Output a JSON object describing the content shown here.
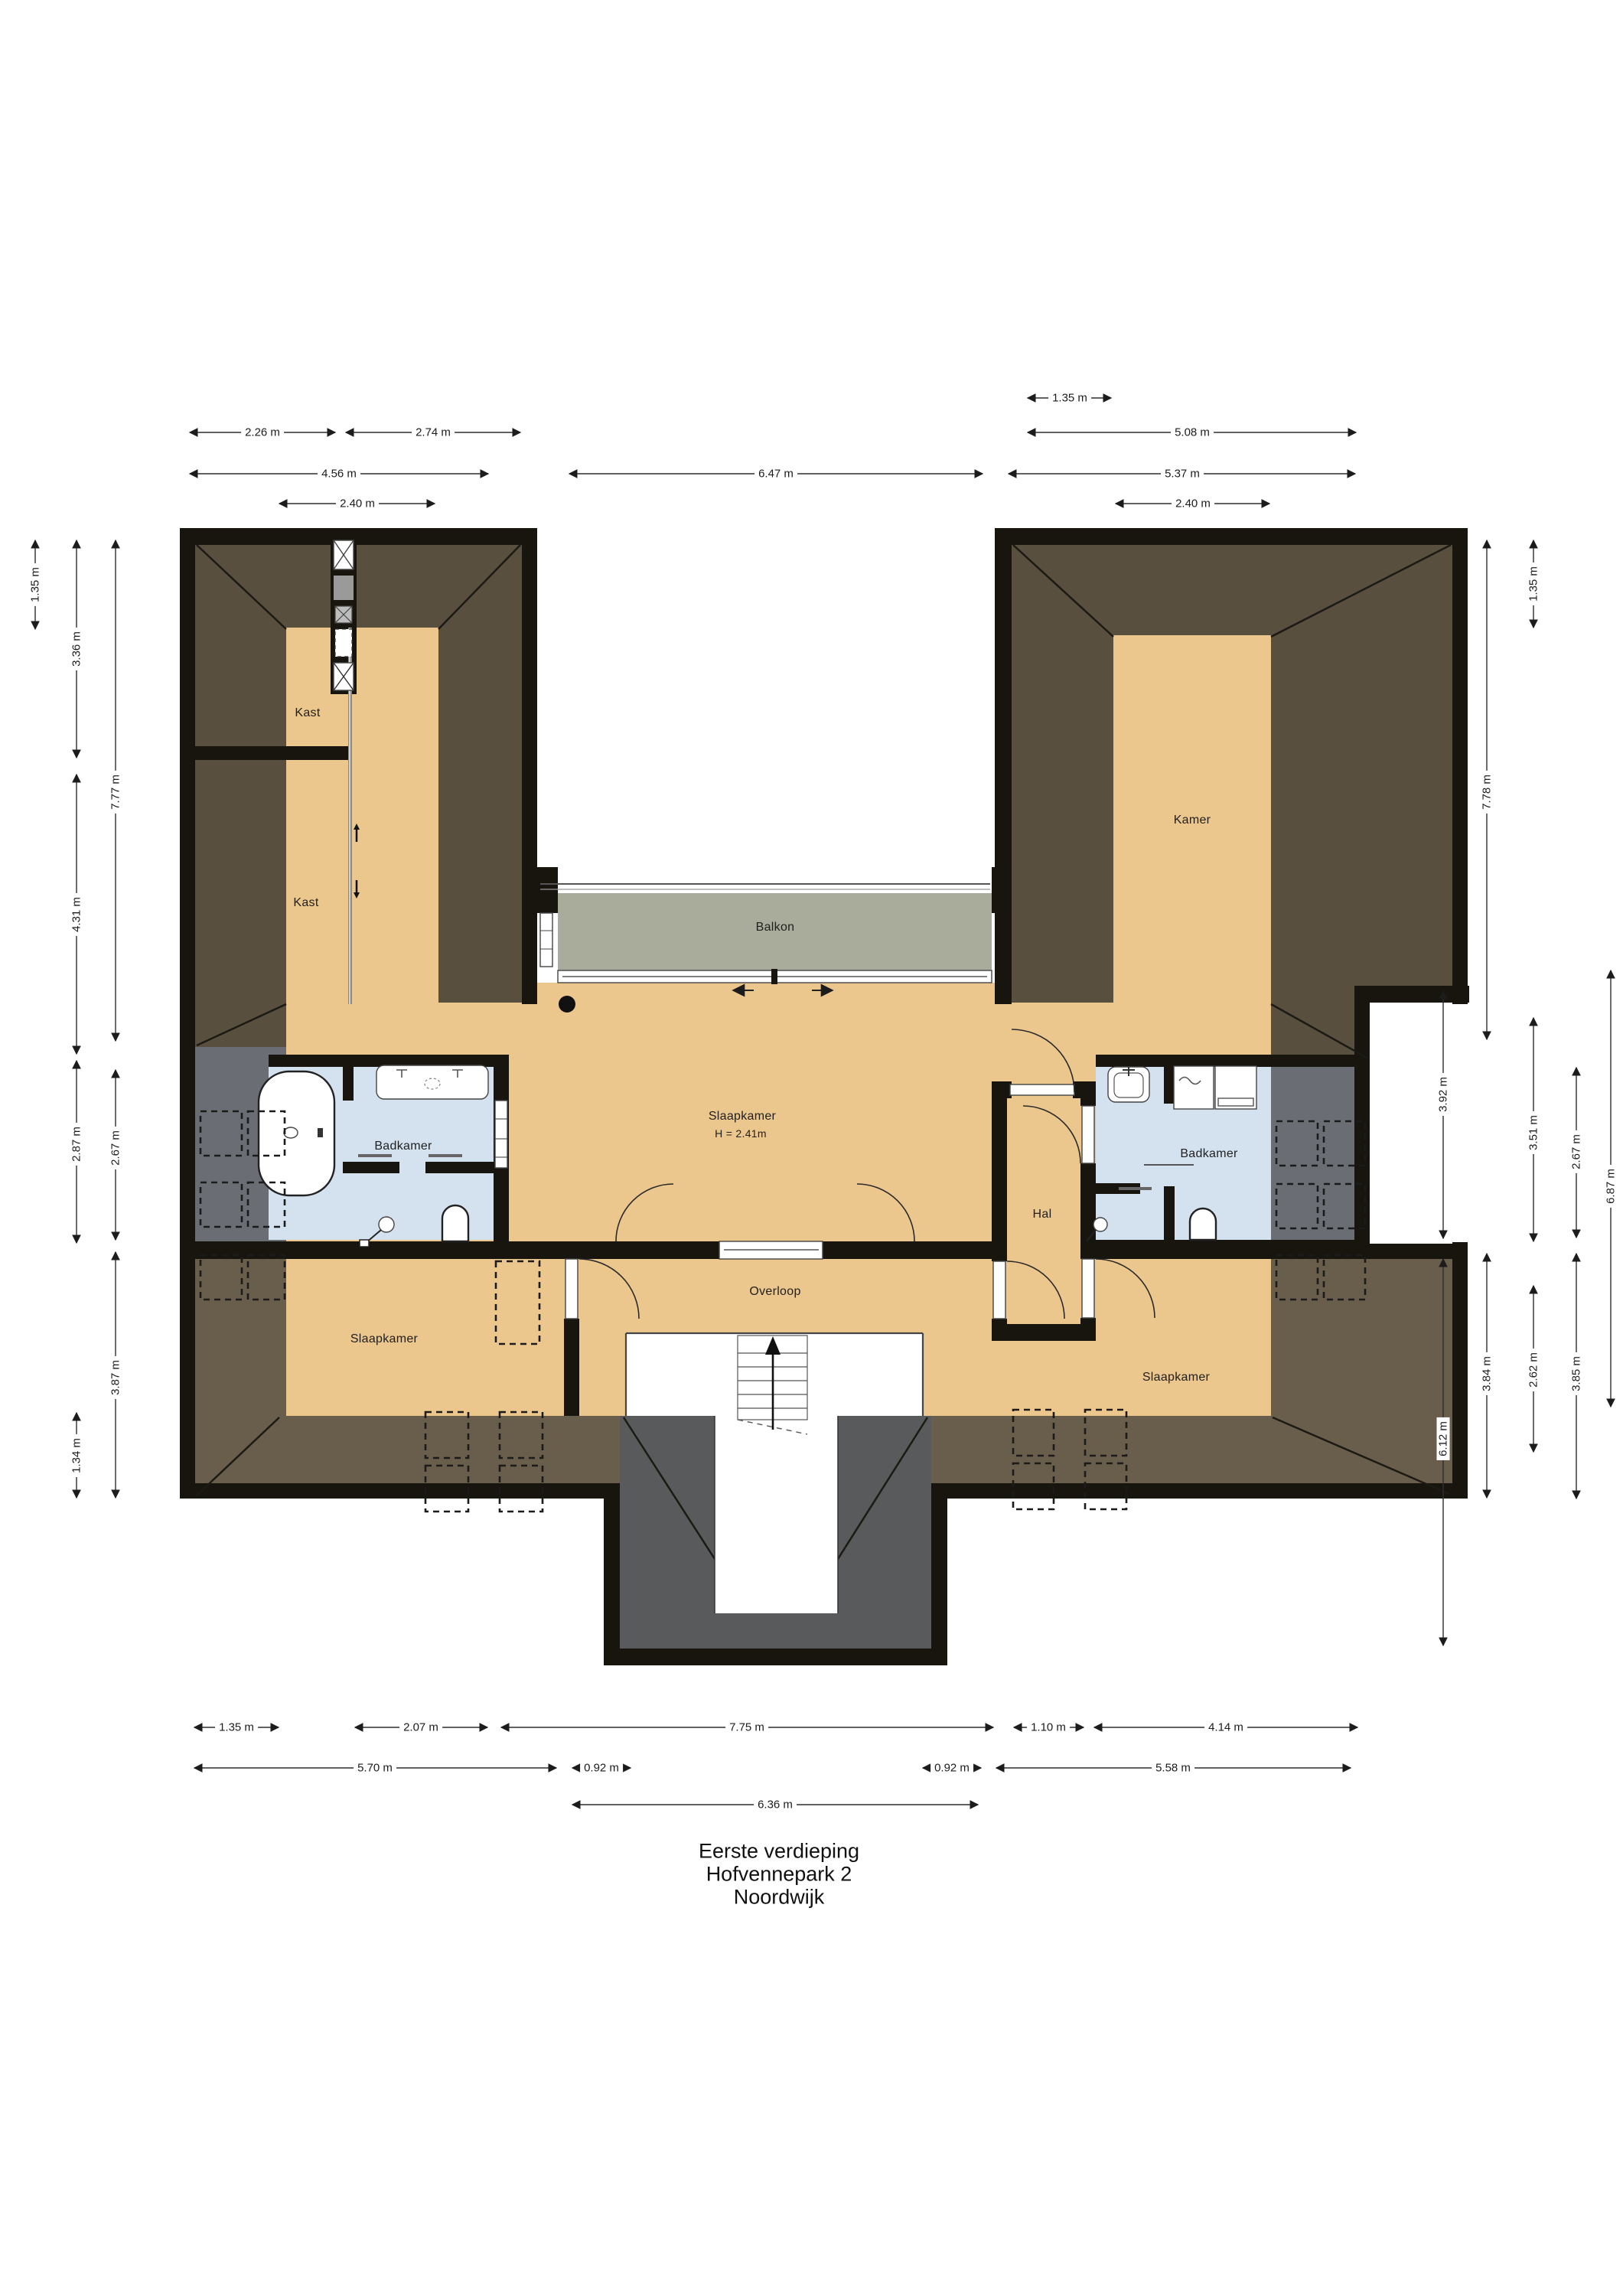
{
  "title": {
    "line1": "Eerste verdieping",
    "line2": "Hofvennepark 2",
    "line3": "Noordwijk"
  },
  "rooms": {
    "kast_top": "Kast",
    "kast_mid": "Kast",
    "kamer": "Kamer",
    "balkon": "Balkon",
    "slaapkamer_center": "Slaapkamer",
    "slaapkamer_center_height": "H = 2.41m",
    "badkamer_left": "Badkamer",
    "badkamer_right": "Badkamer",
    "hal": "Hal",
    "overloop": "Overloop",
    "slaapkamer_left": "Slaapkamer",
    "slaapkamer_right": "Slaapkamer"
  },
  "dimensions": {
    "top": [
      {
        "text": "2.26 m"
      },
      {
        "text": "2.74 m"
      },
      {
        "text": "1.35 m"
      },
      {
        "text": "4.56 m"
      },
      {
        "text": "6.47 m"
      },
      {
        "text": "5.08 m"
      },
      {
        "text": "5.37 m"
      },
      {
        "text": "2.40 m"
      },
      {
        "text": "2.40 m"
      }
    ],
    "left": [
      {
        "text": "1.35 m"
      },
      {
        "text": "3.36 m"
      },
      {
        "text": "4.31 m"
      },
      {
        "text": "7.77 m"
      },
      {
        "text": "2.87 m"
      },
      {
        "text": "2.67 m"
      },
      {
        "text": "3.87 m"
      },
      {
        "text": "1.34 m"
      }
    ],
    "right": [
      {
        "text": "7.78 m"
      },
      {
        "text": "1.35 m"
      },
      {
        "text": "3.92 m"
      },
      {
        "text": "6.12 m"
      },
      {
        "text": "3.84 m"
      },
      {
        "text": "3.51 m"
      },
      {
        "text": "2.62 m"
      },
      {
        "text": "2.67 m"
      },
      {
        "text": "3.85 m"
      },
      {
        "text": "6.87 m"
      }
    ],
    "bottom": [
      {
        "text": "1.35 m"
      },
      {
        "text": "2.07 m"
      },
      {
        "text": "7.75 m"
      },
      {
        "text": "1.10 m"
      },
      {
        "text": "4.14 m"
      },
      {
        "text": "5.70 m"
      },
      {
        "text": "0.92 m"
      },
      {
        "text": "0.92 m"
      },
      {
        "text": "5.58 m"
      },
      {
        "text": "6.36 m"
      }
    ]
  },
  "colors": {
    "wall": "#18150f",
    "roof_band": "#584f3e",
    "roof_band_light": "#695e4b",
    "floor_tan": "#ecc78d",
    "balcony_gray": "#a9ab9b",
    "bathroom_blue": "#d4e2f0",
    "roof_slope_slate": "#6a6e74",
    "stair_tower_gray": "#595a5c"
  }
}
